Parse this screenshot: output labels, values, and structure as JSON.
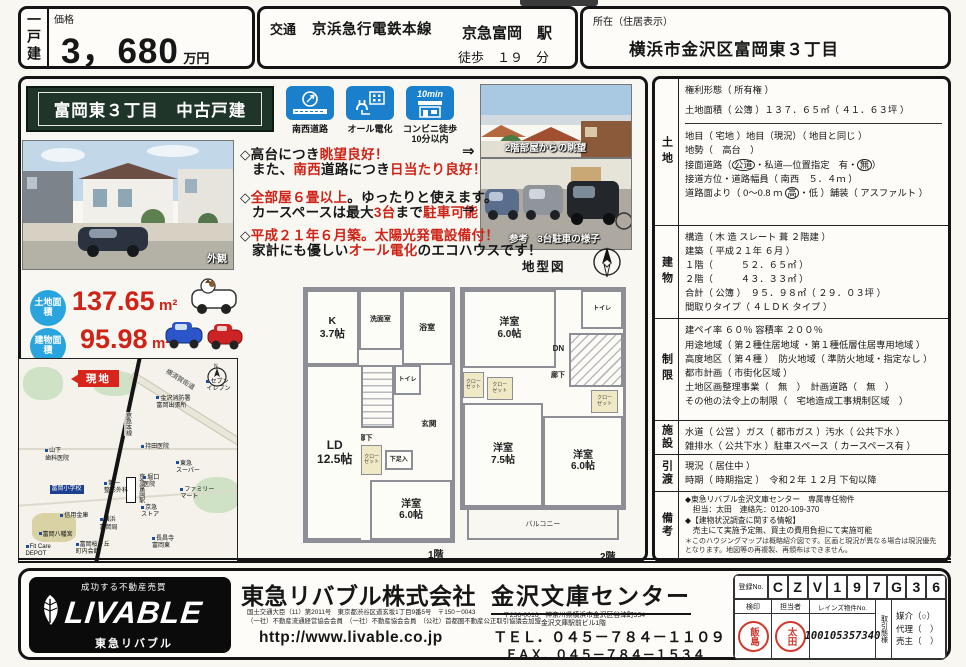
{
  "colors": {
    "accent_red": "#cf2318",
    "icon_blue": "#1b80cc",
    "area_cyan": "#29a4de",
    "banner_green": "#20352a"
  },
  "header": {
    "type_tab": "一戸建",
    "price_label": "価格",
    "price_value": "3，680",
    "price_unit": "万円",
    "traffic_label": "交通",
    "rail_line": "京浜急行電鉄本線",
    "station": "京急富岡　駅",
    "walk": "徒歩　１９　分",
    "loc_label": "所在（住居表示）",
    "loc_value": "横浜市金沢区富岡東３丁目"
  },
  "banner_title": "富岡東３丁目　中古戸建",
  "badges": {
    "b1": "南西道路",
    "b2": "オール電化",
    "b3": "コンビニ徒歩\n10分以内",
    "b3_badge": "10min"
  },
  "photos": {
    "exterior": "外観",
    "view": "2階部屋からの眺望",
    "parking": "参考　3台駐車の様子"
  },
  "points": {
    "p1a": [
      {
        "t": "◇高台につき"
      },
      {
        "t": "眺望良好！",
        "red": 1
      }
    ],
    "p1arrow": "⇒",
    "p1b": [
      {
        "t": "また、"
      },
      {
        "t": "南西",
        "red": 1
      },
      {
        "t": "道路につき"
      },
      {
        "t": "日当たり良好！",
        "red": 1
      }
    ],
    "p2a": [
      {
        "t": "◇"
      },
      {
        "t": "全部屋６畳以上",
        "red": 1
      },
      {
        "t": "。ゆったりと使えます。"
      }
    ],
    "p2b": [
      {
        "t": "カースペースは最大"
      },
      {
        "t": "3台",
        "red": 1
      },
      {
        "t": "まで"
      },
      {
        "t": "駐車可能",
        "red": 1
      }
    ],
    "p2arrow": "⇒",
    "p3a": [
      {
        "t": "◇"
      },
      {
        "t": "平成２１年６月築。太陽光発電設備付！",
        "red": 1
      }
    ],
    "p3b": [
      {
        "t": "家計にも優しい"
      },
      {
        "t": "オール電化",
        "red": 1
      },
      {
        "t": "のエコハウスです！"
      }
    ]
  },
  "areas": {
    "land_label": "土地面積",
    "land_value": "137.65",
    "land_unit": "m²",
    "building_label": "建物面積",
    "building_value": "95.98",
    "building_unit": "m²"
  },
  "map": {
    "site_tag": "現地",
    "rail": "京急本線",
    "station": "京急富岡駅",
    "road": "横須賀街道",
    "labels": [
      {
        "t": "セブン\nイレブン",
        "x": 86,
        "y": 10
      },
      {
        "t": "金沢消防署\n富岡出張所",
        "x": 63,
        "y": 18
      },
      {
        "t": "山下\n歯科医院",
        "x": 12,
        "y": 44
      },
      {
        "t": "持田医院",
        "x": 56,
        "y": 42
      },
      {
        "t": "東急\nスーパー",
        "x": 72,
        "y": 50
      },
      {
        "t": "堀口\n医院",
        "x": 57,
        "y": 57
      },
      {
        "t": "第一\n整形外科",
        "x": 39,
        "y": 60
      },
      {
        "t": "ファミリー\nマート",
        "x": 74,
        "y": 63
      },
      {
        "t": "京急\nストア",
        "x": 56,
        "y": 72
      },
      {
        "t": "横浜\n富岡局",
        "x": 37,
        "y": 78
      },
      {
        "t": "信用金庫",
        "x": 19,
        "y": 76
      },
      {
        "t": "富岡八幡宮",
        "x": 9,
        "y": 85
      },
      {
        "t": "Fit Care\nDEPOT",
        "x": 3,
        "y": 91
      },
      {
        "t": "富岡桜ヶ丘\n町内会館",
        "x": 26,
        "y": 90
      },
      {
        "t": "長昌寺\n富岡東",
        "x": 61,
        "y": 87
      }
    ],
    "school_label": "富岡小学校"
  },
  "plan": {
    "lot_caption": "地型図",
    "f1_caption": "1階",
    "f2_caption": "2階",
    "f1": {
      "k": "K\n3.7帖",
      "wash": "洗面室",
      "bath": "浴室",
      "toilet": "トイレ",
      "up": "UP",
      "hall": "廊下",
      "genkan": "玄関",
      "closet": "クロー\nゼット",
      "shoe": "下足入",
      "ld": "LD\n12.5帖",
      "room": "洋室\n6.0帖"
    },
    "f2": {
      "room1": "洋室\n6.0帖",
      "toilet": "トイレ",
      "dn": "DN",
      "hall": "廊下",
      "closet": "クロー\nゼット",
      "room2": "洋室\n7.5帖",
      "room3": "洋室\n6.0帖",
      "balcony": "バルコニー"
    }
  },
  "details": {
    "land_title": "土地",
    "land": {
      "r1": "権利形態（ 所有権 ）",
      "r2": "土地面積（ 公簿 ）１３７．６５㎡（ ４１．６３坪 ）",
      "r3": "地目（ 宅地 ）地目（現況）（ 地目と同じ ）",
      "r4": "地勢（　高台　）",
      "r5a": "接面道路（",
      "r5b": "公道",
      "r5c": "・私道―位置指定　有・",
      "r5d": "無",
      "r5e": "）",
      "r6": "接道方位・道路幅員（ 南西　５．４ｍ ）",
      "r7a": "道路面より（ 0～0.8 ｍ ",
      "r7b": "高",
      "r7c": "・低 ）舗装（ アスファルト ）"
    },
    "bldg_title": "建物",
    "bldg": {
      "r1": "構造（ 木 造 スレート 葺 ２階建 ）",
      "r2": "建築（ 平成２１年 ６月 ）",
      "r3": "１階（　　　５２．６５㎡ ）",
      "r4": "２階（　　　４３．３３㎡ ）",
      "r5": "合計（ 公簿 ）　９５．９８㎡（ ２９．０３坪 ）",
      "r6": "間取りタイプ（ ４ＬＤＫ タイプ ）"
    },
    "limit_title": "制限",
    "limit": {
      "r1": "建ペイ率 ６０％ 容積率 ２００％",
      "r2": "用途地域（ 第２種住居地域 ・第１種低層住居専用地域 ）",
      "r3": "高度地区（ 第４種 ）　防火地域（ 準防火地域・指定なし ）",
      "r4": "都市計画（ 市街化区域 ）",
      "r5": "土地区画整理事業（　無　）　計画道路（　無　）",
      "r6": "その他の法令上の制限（　宅地造成工事規制区域　）"
    },
    "fac_title": "施設",
    "fac": {
      "r1": "水道（ 公営 ）ガス（ 都市ガス ）汚水（ 公共下水 ）",
      "r2": "雑排水（ 公共下水 ）駐車スペース（ カースペース有 ）"
    },
    "deliv_title": "引渡",
    "deliv": {
      "r1": "現況（ 居住中 ）",
      "r2": "時期（ 時期指定 ）　令和２年 １２月 下旬以降"
    },
    "note_title": "備考",
    "note": {
      "r1": "◆東急リバブル金沢文庫センター　専属専任物件",
      "r2": "　担当：太田　連絡先：0120-109-370",
      "r3": "◆【建物状況調査に関する情報】",
      "r4": "　売主にて実施予定無、買主の費用負担にて実施可能",
      "r5": "＊このハウジングマップは概略紹介図です。区画と現況が異なる場合は現況優先となります。地図等の再複製、再頒布はできません。"
    }
  },
  "footer": {
    "tagline": "成功する不動産売買",
    "logo": "LIVABLE",
    "logo_sub": "東急リバブル",
    "company": "東急リバブル株式会社",
    "license1": "国土交通大臣（11）第2011号　東京都渋谷区道玄坂1丁目9番5号　〒150－0043",
    "license2": "（一社）不動産流通経営協会会員　（一社）不動産協会会員　（公社）首都圏不動産公正取引協議会加盟",
    "url": "http://www.livable.co.jp",
    "center": "金沢文庫センター",
    "addr1": "〒236-0016　神奈川県横浜市金沢区谷津町354",
    "addr2": "金沢文庫駅前ビル1階",
    "tel": "ＴＥＬ．０４５－７８４－１１０９",
    "fax": "ＦＡＸ．０４５－７８４－１５３４",
    "reg_label": "登録No.",
    "reg": [
      "C",
      "Z",
      "V",
      "1",
      "9",
      "7",
      "G",
      "3",
      "6"
    ],
    "kenin": "検印",
    "tanto": "担当者",
    "stamp_kenin": "飯島",
    "stamp_tanto": "太田",
    "reins_label": "レインズ物件No.",
    "reins": "100105357340",
    "mode_label": "取引態様",
    "mode1": "媒介（○）",
    "mode2": "代理（　）",
    "mode3": "売主（　）"
  }
}
